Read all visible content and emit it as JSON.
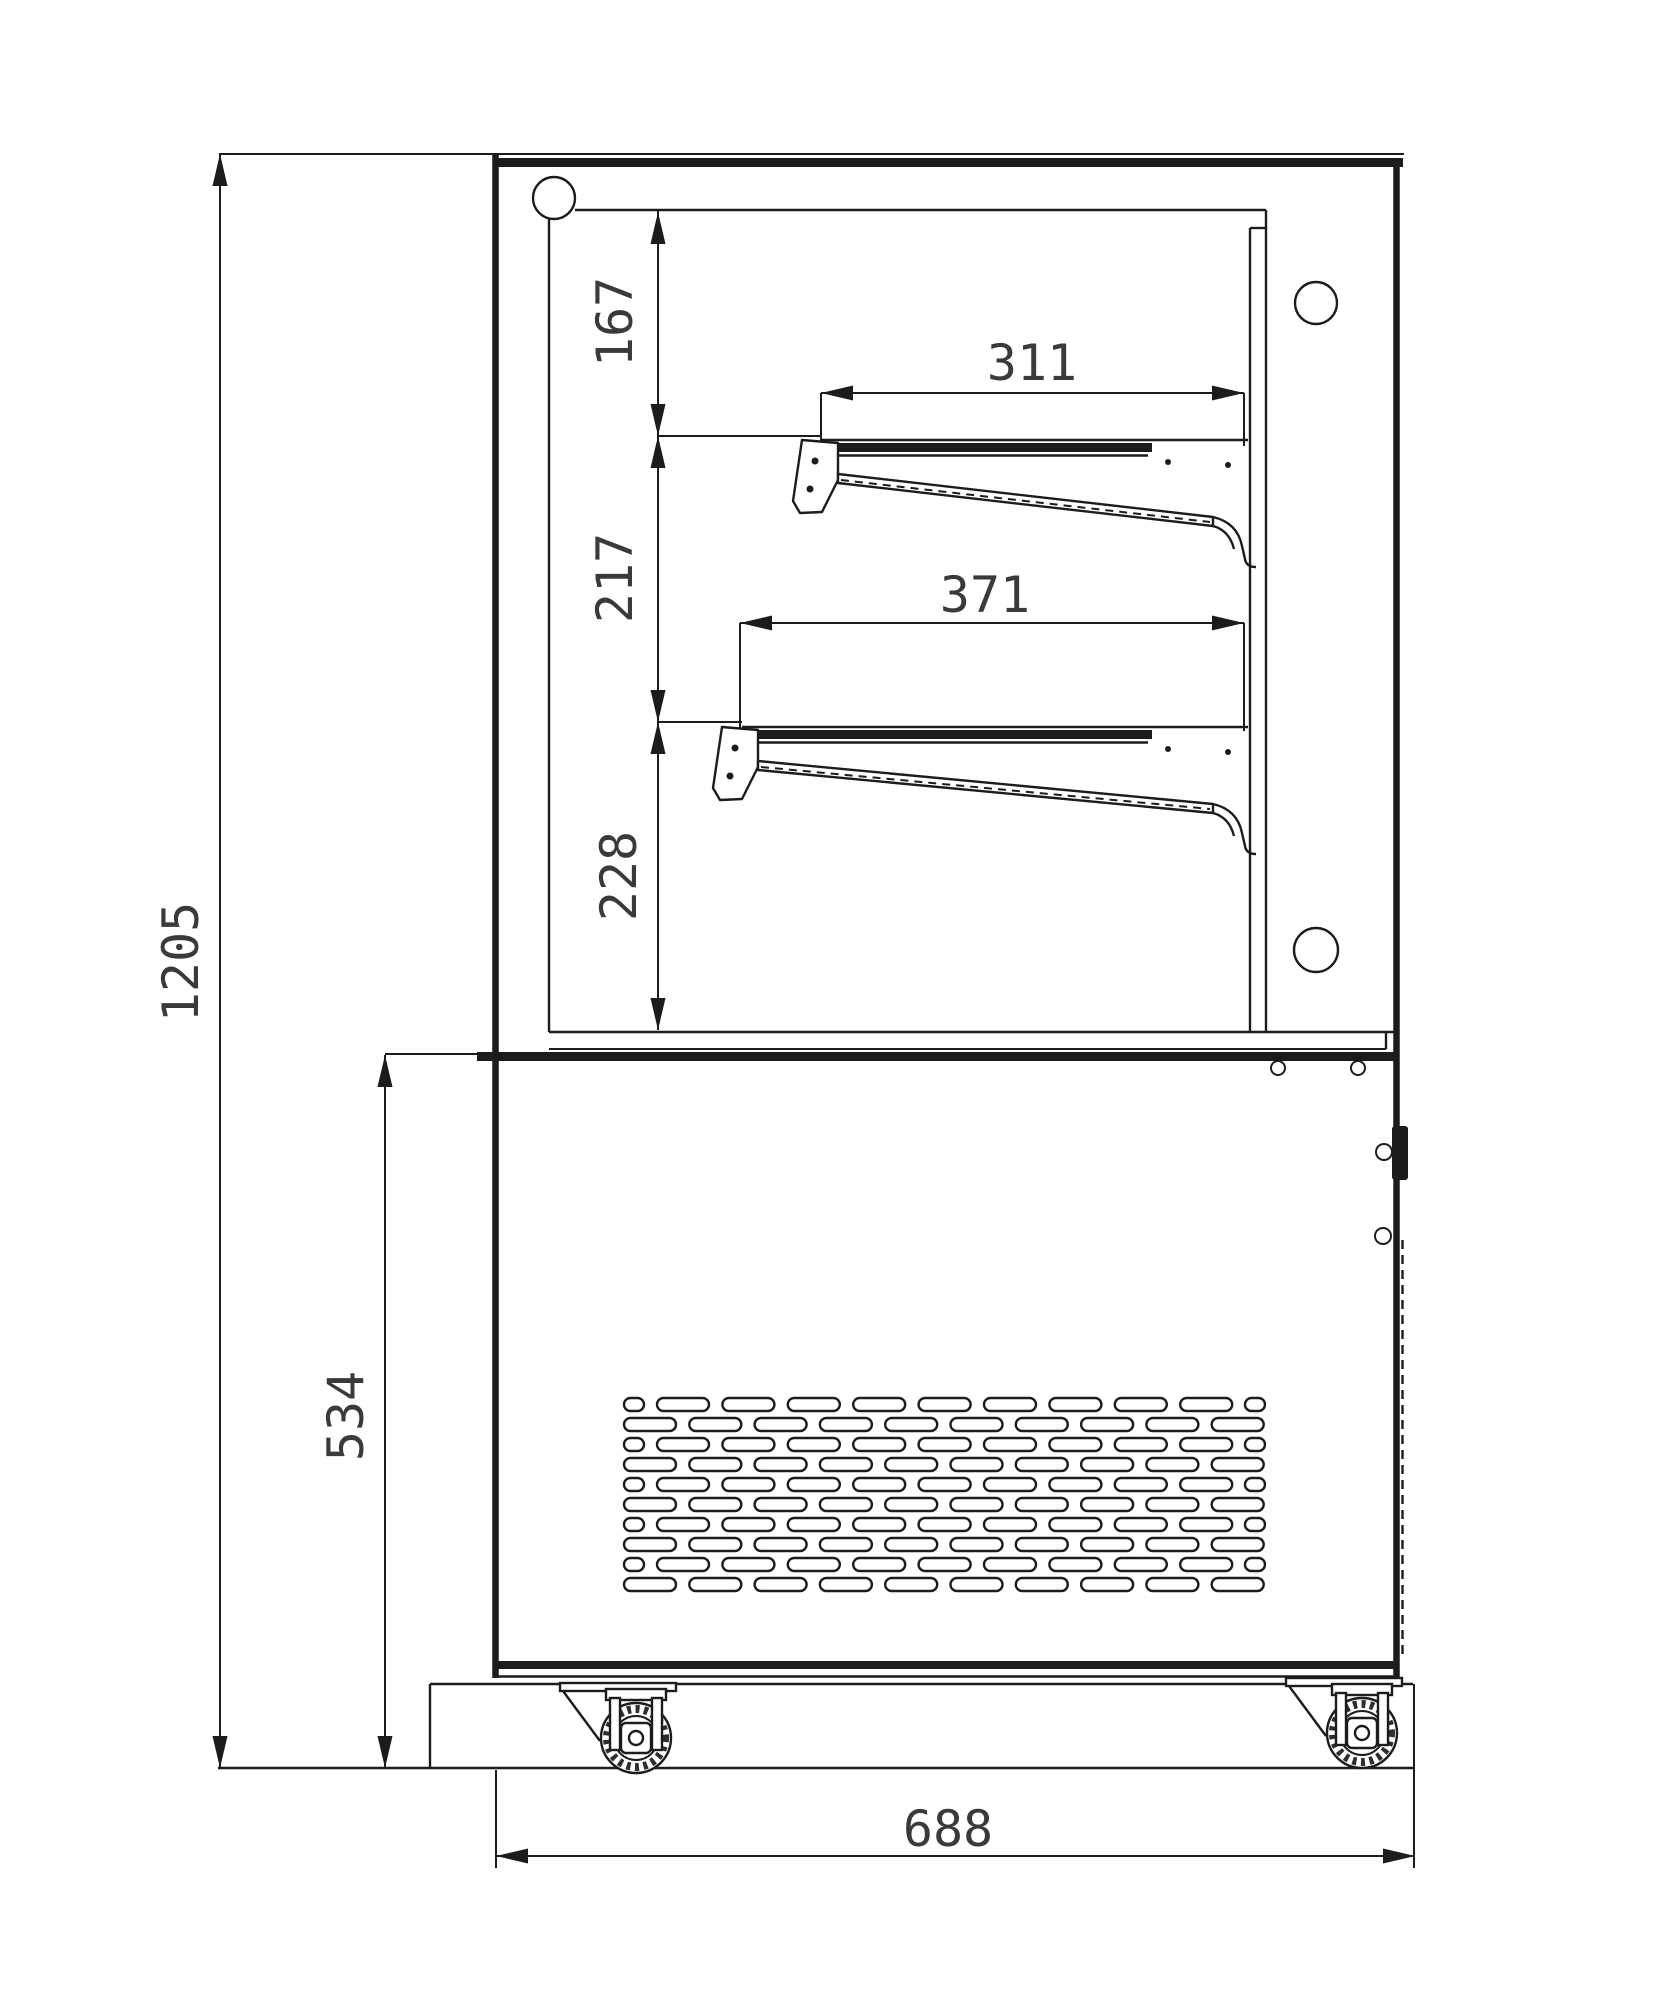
{
  "drawing": {
    "units_note": "mm",
    "colors": {
      "line": "#1c1c1c",
      "text": "#3a3a3a",
      "background": "#ffffff"
    },
    "dimensions": {
      "overall_height": {
        "value": "1205",
        "orientation": "vertical",
        "measures": "total height incl. casters"
      },
      "base_section_height": {
        "value": "534",
        "orientation": "vertical",
        "measures": "lower cabinet height"
      },
      "overall_depth": {
        "value": "688",
        "orientation": "horizontal",
        "measures": "overall depth/width"
      },
      "top_clearance": {
        "value": "167",
        "orientation": "vertical",
        "measures": "top of case to upper shelf"
      },
      "mid_clearance": {
        "value": "217",
        "orientation": "vertical",
        "measures": "upper shelf to lower shelf"
      },
      "bottom_clearance": {
        "value": "228",
        "orientation": "vertical",
        "measures": "lower shelf to deck"
      },
      "upper_shelf_depth": {
        "value": "311",
        "orientation": "horizontal",
        "measures": "upper shelf depth"
      },
      "lower_shelf_depth": {
        "value": "371",
        "orientation": "horizontal",
        "measures": "lower shelf depth"
      }
    },
    "grille": {
      "rows": 10,
      "long_slots_per_row": 10,
      "area": {
        "x": 624,
        "y": 1398,
        "width": 640,
        "height": 193
      }
    },
    "casters": {
      "count": 2
    },
    "shelves": {
      "count": 2,
      "type": "inclined display shelves with support brackets"
    }
  }
}
